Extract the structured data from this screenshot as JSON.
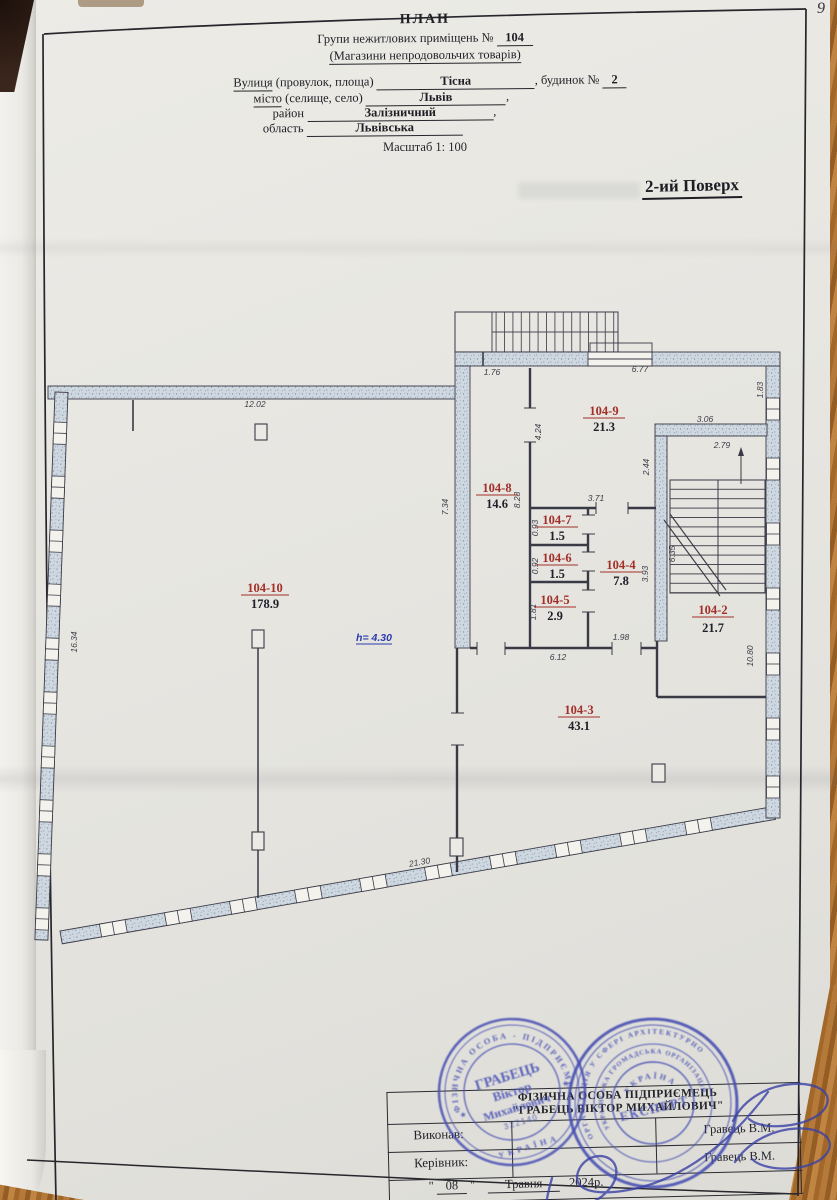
{
  "header": {
    "title": "ПЛАН",
    "subtitle_prefix": "Групи нежитлових приміщень №",
    "subtitle_number": "104",
    "subtitle2": "(Магазини непродовольчих товарів)",
    "addr1_label_u": "Вулиця",
    "addr1_label_rest": " (провулок, площа)",
    "addr1_value": "Тісна",
    "addr1_suffix": ", будинок №",
    "addr1_number": "2",
    "addr2_label_u": "місто",
    "addr2_label_rest": " (селище, село)",
    "addr2_value": "Львів",
    "addr2_suffix": ",",
    "addr3_label": "район",
    "addr3_value": "Залізничний",
    "addr3_suffix": ",",
    "addr4_label": "область",
    "addr4_value": "Львівська",
    "scale_label": "Масштаб 1: 100",
    "floor_title": "2-ий Поверх"
  },
  "plan": {
    "height_note": "h= 4.30",
    "rooms": [
      {
        "num": "104-10",
        "area": "178.9"
      },
      {
        "num": "104-9",
        "area": "21.3"
      },
      {
        "num": "104-8",
        "area": "14.6"
      },
      {
        "num": "104-7",
        "area": "1.5"
      },
      {
        "num": "104-6",
        "area": "1.5"
      },
      {
        "num": "104-5",
        "area": "2.9"
      },
      {
        "num": "104-4",
        "area": "7.8"
      },
      {
        "num": "104-2",
        "area": "21.7"
      },
      {
        "num": "104-3",
        "area": "43.1"
      }
    ],
    "dims": [
      {
        "t": "12.02"
      },
      {
        "t": "1.76"
      },
      {
        "t": "6.77"
      },
      {
        "t": "1.83"
      },
      {
        "t": "3.06"
      },
      {
        "t": "2.79"
      },
      {
        "t": "2.44"
      },
      {
        "t": "4.24"
      },
      {
        "t": "7.34"
      },
      {
        "t": "8.28"
      },
      {
        "t": "3.71"
      },
      {
        "t": "0.93"
      },
      {
        "t": "0.92"
      },
      {
        "t": "1.81"
      },
      {
        "t": "3.93"
      },
      {
        "t": "6.35"
      },
      {
        "t": "1.98"
      },
      {
        "t": "6.12"
      },
      {
        "t": "10.80"
      },
      {
        "t": "16.34"
      },
      {
        "t": "21.30"
      }
    ]
  },
  "footer": {
    "company_line1": "ФІЗИЧНА ОСОБА ПІДПРИЄМЕЦЬ",
    "company_line2": "\"ГРАБЕЦЬ ВІКТОР МИХАЙЛОВИЧ\"",
    "executor_label": "Виконав:",
    "head_label": "Керівник:",
    "executor_name": "Гравець В.М.",
    "head_name": "Гравець В.М.",
    "date_open": "\"",
    "date_day": "08",
    "date_close": "\"",
    "date_month": "Травня",
    "date_year": "2024р.",
    "stamps": {
      "left": {
        "ring_top": "ФІЗИЧНА ОСОБА - ПІДПРИЄМЕЦЬ",
        "ring_bottom": "УКРАЇНА",
        "line1": "ГРАБЕЦЬ",
        "line2": "Віктор",
        "line3": "Михайлович",
        "number": "322140"
      },
      "right": {
        "ring_outer": "ОРГАНІЗАЦІЯ У СФЕРІ АРХІТЕКТУРНО",
        "ring_inner": "УКРАЇНСЬКА ГРОМАДСЬКА ОРГАНІЗАЦІЯ",
        "arc": "УКРАЇНА",
        "center": "ЕКСПЕРТ"
      }
    }
  },
  "misc": {
    "corner_mark": "9"
  },
  "colors": {
    "paper": "#e7e6e1",
    "frame": "#26262c",
    "wall_fill": "#cfd8e0",
    "room_number_red": "#a32f28",
    "height_note_blue": "#2b3dae",
    "stamp_ink": "#4650b4",
    "wood": "#a86d2e"
  }
}
